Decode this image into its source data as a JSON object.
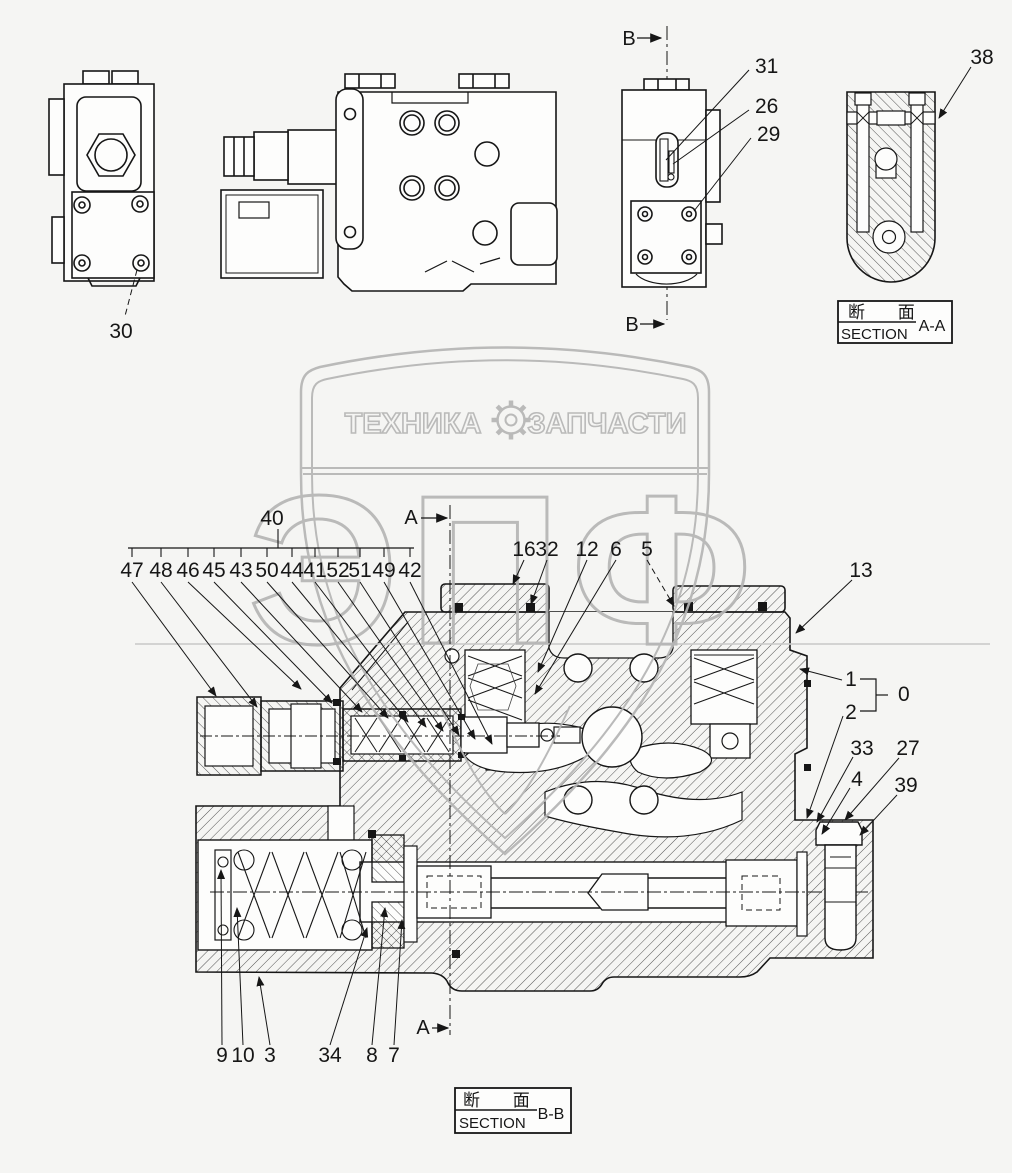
{
  "watermark": {
    "banner_left": "ТЕХНИКА",
    "banner_right": "ЗАПЧАСТИ",
    "logo": "ЭПФ"
  },
  "top_views": {
    "left_callout": "30",
    "b_top": "B",
    "b_bottom": "B",
    "c31": "31",
    "c26": "26",
    "c29": "29",
    "c38": "38"
  },
  "boxes": {
    "aa": {
      "cn": "断 面",
      "en": "SECTION",
      "ref": "A-A"
    },
    "bb": {
      "cn": "断 面",
      "en": "SECTION",
      "ref": "B-B"
    }
  },
  "main": {
    "bracket": "40",
    "row": [
      "47",
      "48",
      "46",
      "45",
      "43",
      "50",
      "44",
      "41",
      "52",
      "51",
      "49",
      "42"
    ],
    "top": [
      "16",
      "32",
      "12",
      "6",
      "5"
    ],
    "c13": "13",
    "c1": "1",
    "c0": "0",
    "c2": "2",
    "c33": "33",
    "c27": "27",
    "c4": "4",
    "c39": "39",
    "bottom": [
      "9",
      "10",
      "3",
      "34",
      "8",
      "7"
    ],
    "a_top": "A",
    "a_bottom": "A"
  }
}
